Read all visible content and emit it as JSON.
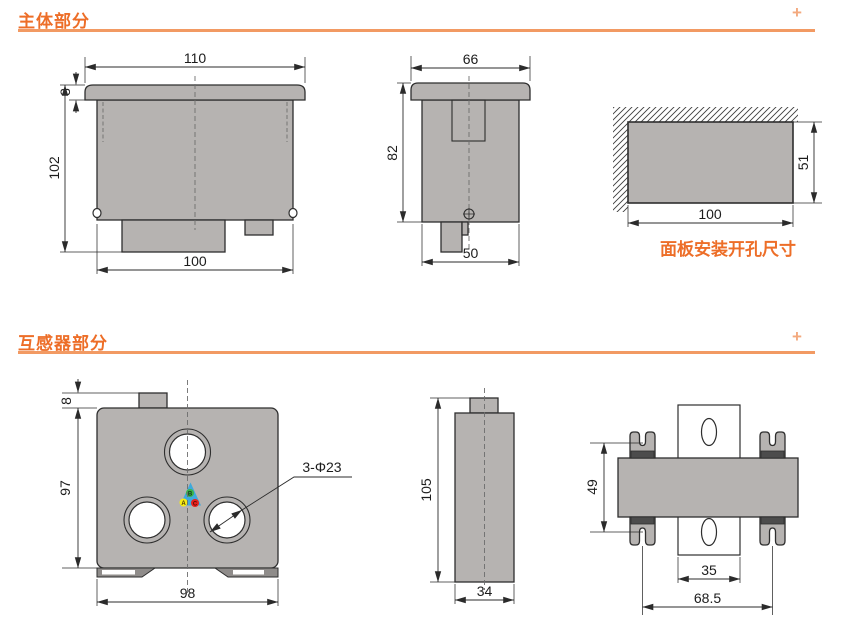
{
  "sections": {
    "main": {
      "title": "主体部分",
      "plus": "+"
    },
    "ct": {
      "title": "互感器部分",
      "plus": "+"
    }
  },
  "main_front": {
    "top_width": "110",
    "bezel_depth": "8",
    "height": "102",
    "body_width": "100"
  },
  "main_side": {
    "top_width": "66",
    "height": "82",
    "bottom_width": "50"
  },
  "cutout": {
    "width": "100",
    "height": "51",
    "caption": "面板安装开孔尺寸"
  },
  "ct_front": {
    "tab_height": "8",
    "height": "97",
    "width": "98",
    "holes_label": "3-Φ23",
    "phases": {
      "a": "A",
      "b": "B",
      "c": "C"
    }
  },
  "ct_side": {
    "height": "105",
    "width": "34"
  },
  "ct_top": {
    "clip_span": "49",
    "rail_width": "35",
    "overall_span": "68.5"
  },
  "colors": {
    "accent": "#ed6e28",
    "rule": "#f29a63",
    "fill_gray": "#b6b3b1",
    "phase_a": "#f7ec13",
    "phase_b": "#3ab54a",
    "phase_c": "#e6231e",
    "triangle": "#3fa9dc"
  }
}
